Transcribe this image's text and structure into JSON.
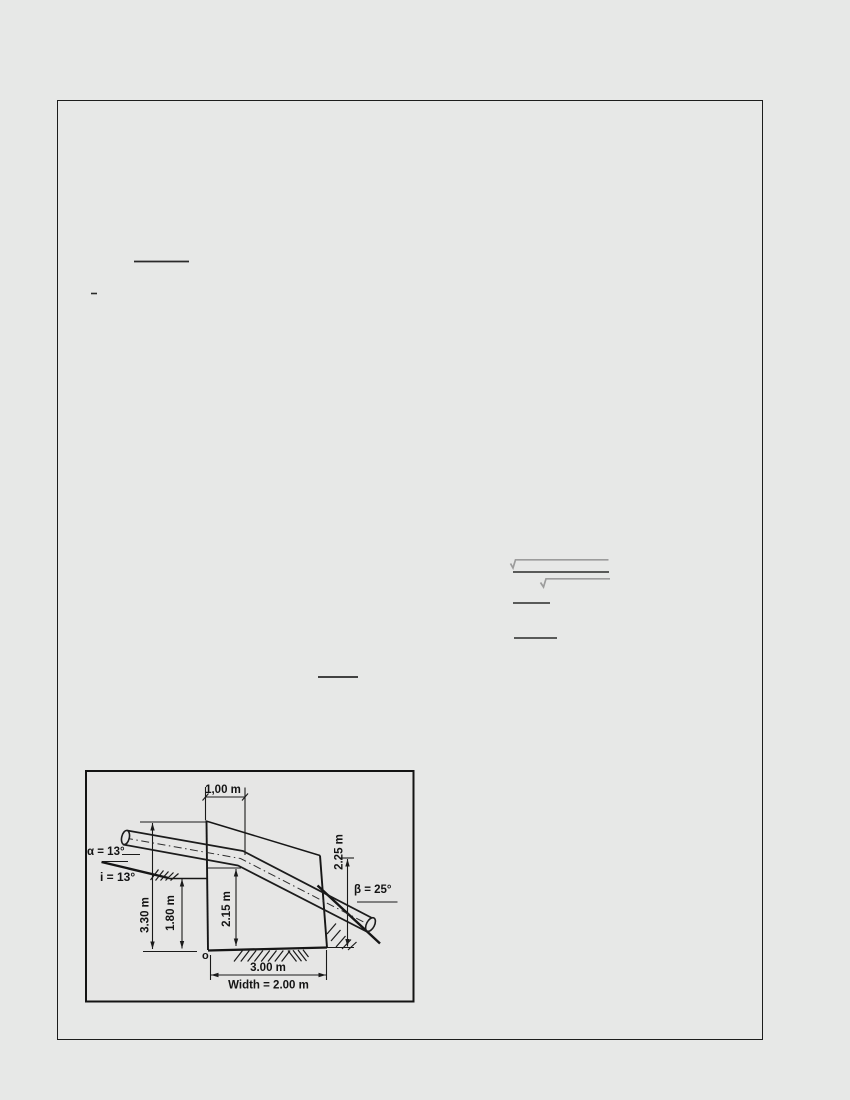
{
  "page": {
    "background_color": "#e7e8e7",
    "frame_border_color": "#1d1d1d"
  },
  "equation_marks": {
    "ink_color": "#2a2a2a",
    "radical_color": "#9c9c9c",
    "description_fraction_bars": [
      "fraction-bar",
      "minus-dash",
      "underline",
      "fraction-bar-small",
      "fraction-bar-small-2",
      "fraction-bar-mid"
    ],
    "description_radicals": [
      "sqrt-overbar-1",
      "sqrt-overbar-2"
    ]
  },
  "figure": {
    "background_color": "#e6e6e5",
    "border_color": "#141414",
    "ink_color": "#141414",
    "labels": {
      "top_width": "1,00 m",
      "alpha": "α = 13°",
      "slope_i": "i = 13°",
      "depth_total": "3.30 m",
      "depth_bench": "1.80 m",
      "depth_pipe": "2.15 m",
      "depth_right": "2.25 m",
      "beta": "β = 25°",
      "origin": "o",
      "bottom_length": "3.00 m",
      "trench_width": "Width = 2.00 m"
    }
  }
}
